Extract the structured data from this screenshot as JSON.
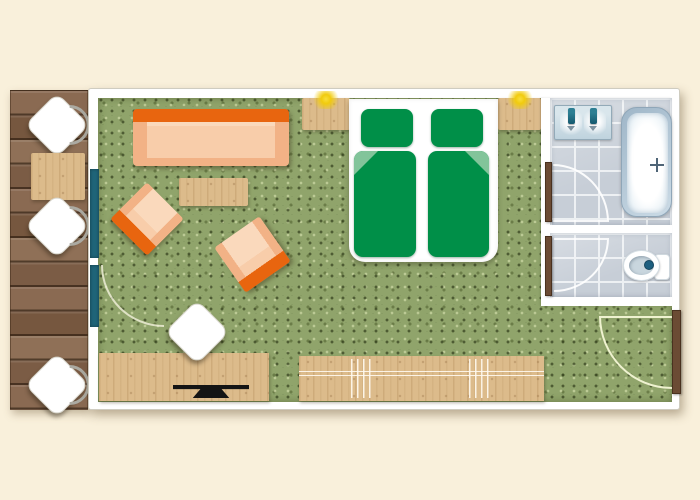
{
  "title": "",
  "colors": {
    "bg_cream": "#F9F0DB",
    "wall_white": "#FFFFFF",
    "deck_wood": "#7E5F48",
    "furn_wood": "#DCBB8B",
    "carpet_green": "#90A46B",
    "window_teal": "#1F6478",
    "sofa_back": "#E8650F",
    "sofa_body": "#F8CDAA",
    "sofa_arm": "#F2B286",
    "sofa_seat": "#FAD9BC",
    "bed_green": "#008F48",
    "bed_fold": "#82C49A",
    "tile_grey": "#C7CED7",
    "grout": "#EDF0F3",
    "fixture_blue": "#BFD3DE",
    "faucet_teal": "#15596F",
    "door_brown": "#6B4B34",
    "lamp_yellow": "#F1CB0E",
    "tv_black": "#141414",
    "button_blue": "#1D5F80",
    "arc_pale": "#EFF2D0"
  },
  "plan": {
    "balcony": {
      "chairs": 3,
      "tables": 1,
      "glazing_segments": 2
    },
    "bedroom": {
      "sofas": 1,
      "armchairs": 2,
      "coffee_tables": 1,
      "beds": 2,
      "pillows": 2,
      "duvets": 2,
      "nightstands": 2,
      "wall_lamps": 2,
      "desks": 1,
      "desk_chairs": 1,
      "tvs": 1,
      "sideboards": 1
    },
    "bathroom": {
      "washbasin_faucets": 2,
      "bathtubs": 1,
      "toilets": 1
    },
    "doors": {
      "entrance": 1,
      "bathroom": 1,
      "wc": 1
    }
  }
}
